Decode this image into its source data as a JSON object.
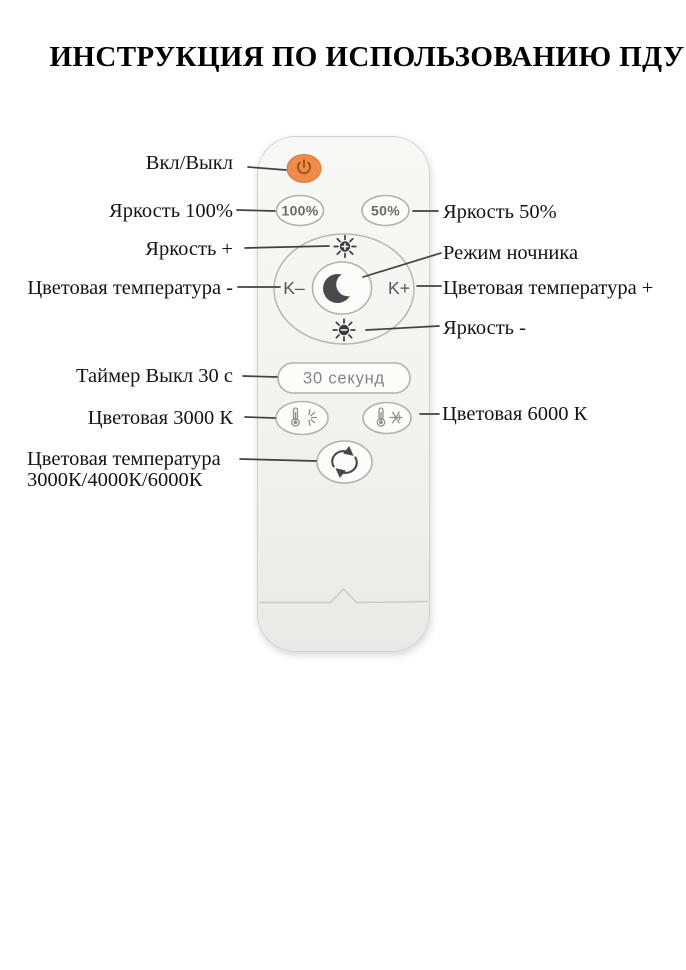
{
  "title": "ИНСТРУКЦИЯ ПО ИСПОЛЬЗОВАНИЮ ПДУ",
  "annotations": {
    "power": "Вкл/Выкл",
    "brightness_100": "Яркость 100%",
    "brightness_plus": "Яркость +",
    "color_temp_minus": "Цветовая температура -",
    "timer": "Таймер Выкл 30 с",
    "color_3000": "Цветовая 3000 К",
    "color_cycle_line1": "Цветовая температура",
    "color_cycle_line2": "3000К/4000К/6000К",
    "brightness_50": "Яркость 50%",
    "night_mode": "Режим ночника",
    "color_temp_plus": "Цветовая температура +",
    "brightness_minus": "Яркость -",
    "color_6000": "Цветовая 6000 К"
  },
  "remote_buttons": {
    "brightness_100_label": "100%",
    "brightness_50_label": "50%",
    "kelvin_minus_label": "K–",
    "kelvin_plus_label": "K+",
    "timer_label": "30 секунд"
  },
  "icons": {
    "power": "power-symbol",
    "brightness_up": "sun-plus",
    "brightness_down": "sun-minus",
    "night_mode": "crescent-moon",
    "warm": "thermometer-sun-rays",
    "cold": "thermometer-snowflake",
    "cycle": "circular-arrows"
  },
  "colors": {
    "power_button": "#ee8a4a",
    "power_icon": "#9a541b",
    "label_text": "#141414",
    "connector_line": "#414141",
    "button_border": "#b2b2b0",
    "button_text": "#6b6b69",
    "icon_dark": "#3b3b3b",
    "remote_body": "#f3f3f1"
  }
}
